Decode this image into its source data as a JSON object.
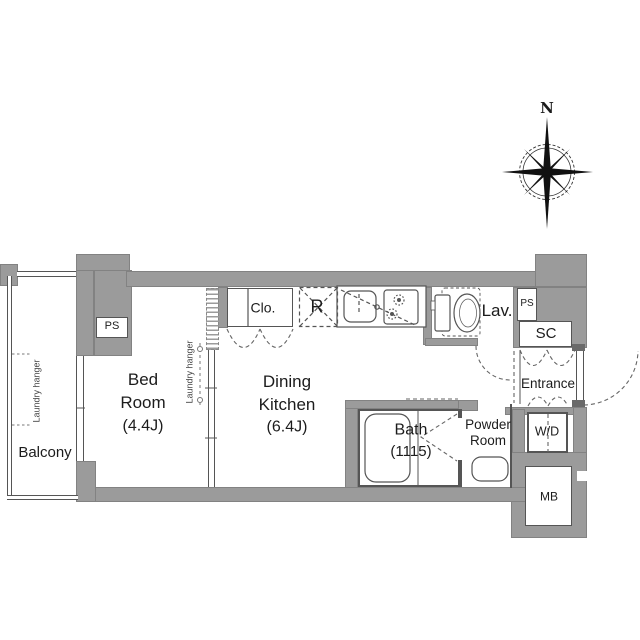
{
  "compass": {
    "north_label": "N"
  },
  "rooms": {
    "balcony": {
      "label": "Balcony"
    },
    "bedroom": {
      "line1": "Bed",
      "line2": "Room",
      "size": "(4.4J)"
    },
    "dining_kitchen": {
      "line1": "Dining",
      "line2": "Kitchen",
      "size": "(6.4J)"
    },
    "bath": {
      "label": "Bath",
      "size": "(1115)"
    },
    "powder_room": {
      "line1": "Powder",
      "line2": "Room"
    },
    "lavatory": {
      "label": "Lav."
    },
    "entrance": {
      "label": "Entrance"
    },
    "closet": {
      "label": "Clo."
    },
    "shoe_closet": {
      "label": "SC"
    },
    "washer_dryer": {
      "label": "W/D"
    },
    "meter_box": {
      "label": "MB"
    },
    "refrigerator": {
      "label": "R"
    },
    "pipe_space_left": {
      "label": "PS"
    },
    "pipe_space_right": {
      "label": "PS"
    }
  },
  "annotations": {
    "laundry_hanger_balcony": "Laundry hanger",
    "laundry_hanger_bedroom": "Laundry hanger"
  },
  "colors": {
    "wall": "#9b9b9b",
    "line": "#555555",
    "text": "#1c1c1c",
    "background": "#ffffff"
  }
}
